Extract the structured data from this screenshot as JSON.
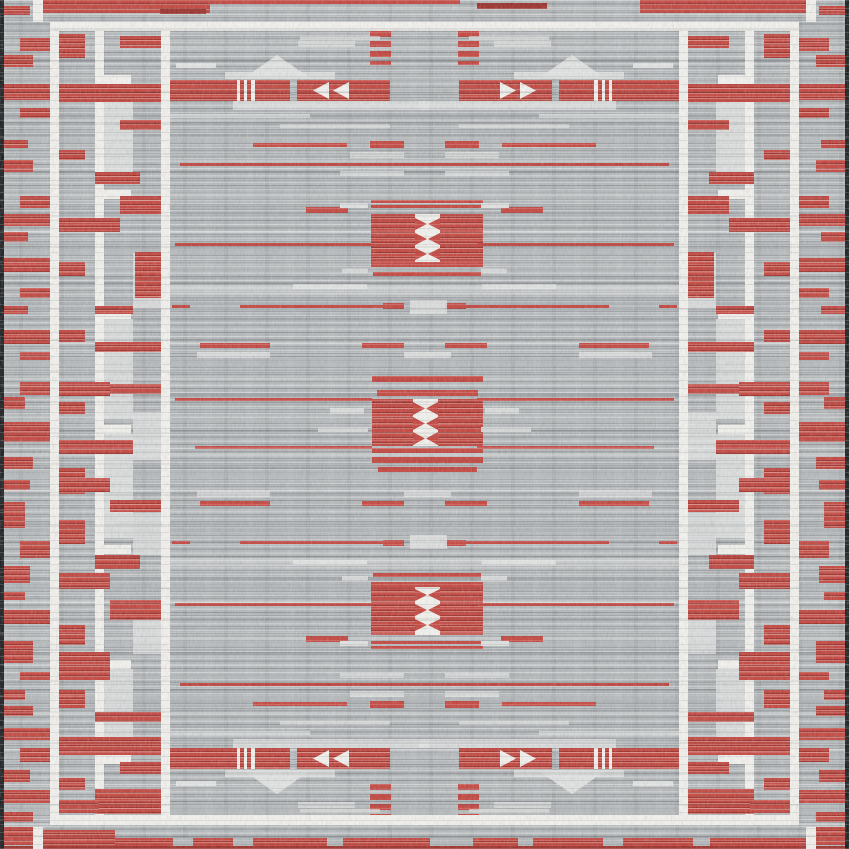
{
  "description": "Flat-woven area rug, top view: gray striated field with red geometric bands, white framing lines and ladder guards, three central red medallions with white hourglass motifs, pyramid motifs above and below the red banner rows, red-flecked outer border and dark selvage edges",
  "palette": {
    "base": "#b4b8ba",
    "black": "#17181a",
    "white": "#f4f3ef",
    "light": "#d6d9d8",
    "lighter": "#e2e4e3",
    "shadow": "#8f959a",
    "red": "#c5413a",
    "red_dark": "#9c2b25",
    "red_light": "#d4766d"
  },
  "pattern": {
    "canvas": {
      "w": 849,
      "h": 849
    },
    "element_format": "[x, y, w, h, colorKey, mirrorCode(1=mirrorX,2=mirrorY,3=both), triangleDir, opacity]",
    "elements": [
      [
        4,
        110,
        841,
        14,
        "g",
        0,
        "",
        0.2
      ],
      [
        4,
        298,
        841,
        10,
        "g",
        0,
        "",
        0.18
      ],
      [
        4,
        520,
        841,
        12,
        "g",
        0,
        "",
        0.15
      ],
      [
        4,
        700,
        841,
        9,
        "g",
        0,
        "",
        0.18
      ],
      [
        170,
        285,
        509,
        9,
        "ll",
        0,
        "",
        0.5
      ],
      [
        170,
        558,
        509,
        8,
        "ll",
        0,
        "",
        0.45
      ],
      [
        95,
        31,
        9,
        784,
        "w",
        1
      ],
      [
        95,
        75,
        36,
        9,
        "w",
        1
      ],
      [
        95,
        190,
        36,
        9,
        "w",
        1
      ],
      [
        95,
        310,
        36,
        9,
        "w",
        1
      ],
      [
        95,
        425,
        36,
        9,
        "w",
        1
      ],
      [
        95,
        545,
        36,
        9,
        "w",
        1
      ],
      [
        95,
        660,
        36,
        9,
        "w",
        1
      ],
      [
        95,
        755,
        36,
        9,
        "w",
        1
      ],
      [
        104,
        84,
        29,
        100,
        "ll",
        1,
        "",
        0.85
      ],
      [
        104,
        319,
        29,
        100,
        "ll",
        1,
        "",
        0.8
      ],
      [
        104,
        434,
        29,
        104,
        "ll",
        1,
        "",
        0.85
      ],
      [
        104,
        669,
        29,
        80,
        "ll",
        1,
        "",
        0.8
      ],
      [
        133,
        253,
        28,
        55,
        "ll",
        1,
        "",
        0.8
      ],
      [
        133,
        412,
        28,
        48,
        "ll",
        1,
        "",
        0.8
      ],
      [
        133,
        513,
        28,
        42,
        "ll",
        1,
        "",
        0.75
      ],
      [
        133,
        608,
        28,
        46,
        "ll",
        1,
        "",
        0.8
      ],
      [
        43,
        0,
        167,
        13,
        "r"
      ],
      [
        210,
        0,
        250,
        4,
        "rs"
      ],
      [
        477,
        3,
        70,
        6,
        "dr"
      ],
      [
        640,
        0,
        166,
        13,
        "r"
      ],
      [
        160,
        9,
        46,
        5,
        "dr"
      ],
      [
        4,
        827,
        29,
        18,
        "r"
      ],
      [
        43,
        830,
        72,
        16,
        "r"
      ],
      [
        115,
        838,
        691,
        11,
        "r"
      ],
      [
        173,
        838,
        20,
        11,
        "b"
      ],
      [
        233,
        838,
        20,
        11,
        "b"
      ],
      [
        327,
        838,
        16,
        11,
        "b"
      ],
      [
        430,
        838,
        43,
        11,
        "b"
      ],
      [
        518,
        838,
        15,
        11,
        "b"
      ],
      [
        603,
        838,
        20,
        11,
        "b"
      ],
      [
        693,
        838,
        17,
        11,
        "b"
      ],
      [
        816,
        827,
        29,
        18,
        "r"
      ],
      [
        4,
        846,
        841,
        3,
        "dr"
      ],
      [
        3,
        6,
        27,
        9,
        "r",
        1
      ],
      [
        20,
        38,
        30,
        13,
        "r",
        1
      ],
      [
        3,
        55,
        30,
        12,
        "r",
        1
      ],
      [
        3,
        84,
        47,
        16,
        "r",
        1
      ],
      [
        20,
        108,
        30,
        10,
        "r",
        1
      ],
      [
        3,
        140,
        25,
        8,
        "r",
        1
      ],
      [
        3,
        160,
        30,
        12,
        "r",
        1
      ],
      [
        20,
        196,
        30,
        12,
        "r",
        1
      ],
      [
        3,
        214,
        47,
        12,
        "r",
        1
      ],
      [
        3,
        232,
        25,
        10,
        "r",
        1
      ],
      [
        3,
        258,
        47,
        14,
        "r",
        1
      ],
      [
        20,
        288,
        30,
        10,
        "r",
        1
      ],
      [
        3,
        306,
        25,
        8,
        "r",
        1
      ],
      [
        3,
        330,
        47,
        14,
        "r",
        1
      ],
      [
        20,
        352,
        30,
        8,
        "r",
        1
      ],
      [
        20,
        382,
        30,
        13,
        "r",
        1
      ],
      [
        3,
        397,
        22,
        12,
        "r",
        1
      ],
      [
        3,
        422,
        47,
        20,
        "r",
        1
      ],
      [
        3,
        457,
        30,
        12,
        "r",
        1
      ],
      [
        3,
        480,
        27,
        10,
        "r",
        1
      ],
      [
        3,
        502,
        22,
        26,
        "r",
        1
      ],
      [
        20,
        541,
        30,
        17,
        "r",
        1
      ],
      [
        3,
        566,
        27,
        17,
        "r",
        1
      ],
      [
        3,
        592,
        22,
        8,
        "r",
        1
      ],
      [
        3,
        610,
        47,
        14,
        "r",
        1
      ],
      [
        3,
        641,
        30,
        22,
        "r",
        1
      ],
      [
        20,
        672,
        30,
        8,
        "r",
        1
      ],
      [
        3,
        690,
        22,
        10,
        "r",
        1
      ],
      [
        3,
        706,
        30,
        10,
        "r",
        1
      ],
      [
        3,
        728,
        47,
        12,
        "r",
        1
      ],
      [
        20,
        748,
        30,
        14,
        "r",
        1
      ],
      [
        3,
        770,
        27,
        12,
        "r",
        1
      ],
      [
        3,
        790,
        47,
        13,
        "r",
        1
      ],
      [
        3,
        812,
        30,
        10,
        "r",
        1
      ],
      [
        58,
        34,
        27,
        24,
        "r",
        1
      ],
      [
        120,
        36,
        41,
        12,
        "r",
        1
      ],
      [
        58,
        84,
        103,
        18,
        "r",
        1
      ],
      [
        120,
        120,
        41,
        10,
        "r",
        1
      ],
      [
        58,
        150,
        27,
        10,
        "r",
        1
      ],
      [
        95,
        172,
        45,
        12,
        "r",
        1
      ],
      [
        120,
        196,
        41,
        18,
        "r",
        1
      ],
      [
        58,
        218,
        62,
        14,
        "r",
        1
      ],
      [
        135,
        252,
        26,
        46,
        "r",
        1
      ],
      [
        58,
        262,
        27,
        14,
        "r",
        1
      ],
      [
        95,
        306,
        38,
        8,
        "r",
        1
      ],
      [
        58,
        330,
        27,
        12,
        "r",
        1
      ],
      [
        95,
        342,
        66,
        10,
        "r",
        1
      ],
      [
        58,
        382,
        52,
        14,
        "r",
        1
      ],
      [
        110,
        384,
        51,
        10,
        "r",
        1
      ],
      [
        58,
        402,
        27,
        12,
        "r",
        1
      ],
      [
        58,
        440,
        75,
        14,
        "r",
        1
      ],
      [
        58,
        468,
        27,
        26,
        "r",
        1
      ],
      [
        85,
        478,
        25,
        14,
        "r",
        1
      ],
      [
        110,
        500,
        51,
        12,
        "r",
        1
      ],
      [
        58,
        520,
        27,
        24,
        "r",
        1
      ],
      [
        95,
        555,
        45,
        14,
        "r",
        1
      ],
      [
        58,
        573,
        52,
        16,
        "r",
        1
      ],
      [
        110,
        600,
        51,
        20,
        "r",
        1
      ],
      [
        58,
        625,
        27,
        20,
        "r",
        1
      ],
      [
        58,
        652,
        52,
        28,
        "r",
        1
      ],
      [
        58,
        690,
        27,
        18,
        "r",
        1
      ],
      [
        95,
        712,
        66,
        10,
        "r",
        1
      ],
      [
        58,
        737,
        103,
        18,
        "r",
        1
      ],
      [
        120,
        762,
        41,
        12,
        "r",
        1
      ],
      [
        58,
        778,
        27,
        12,
        "r",
        1
      ],
      [
        95,
        789,
        66,
        25,
        "r",
        1
      ],
      [
        58,
        800,
        41,
        13,
        "r",
        1
      ],
      [
        370,
        31,
        21,
        34,
        "rv",
        3
      ],
      [
        298,
        41,
        57,
        6,
        "l",
        3
      ],
      [
        176,
        63,
        40,
        5,
        "ll",
        3
      ],
      [
        300,
        36,
        80,
        4,
        "ll",
        3,
        "",
        0.7
      ],
      [
        244,
        55,
        66,
        23,
        "ll",
        3,
        "up"
      ],
      [
        225,
        72,
        110,
        7,
        "ll",
        3,
        "",
        0.85
      ],
      [
        170,
        80,
        120,
        21,
        "r",
        3
      ],
      [
        237,
        80,
        3,
        21,
        "w",
        3
      ],
      [
        244,
        80,
        3,
        21,
        "w",
        3
      ],
      [
        251,
        80,
        4,
        21,
        "w",
        3
      ],
      [
        297,
        80,
        93,
        21,
        "r",
        3
      ],
      [
        313,
        82,
        16,
        17,
        "w",
        3,
        "left"
      ],
      [
        333,
        82,
        16,
        17,
        "w",
        3,
        "left"
      ],
      [
        233,
        101,
        197,
        9,
        "ll",
        3,
        "",
        0.8
      ],
      [
        170,
        114,
        140,
        4,
        "ll",
        3,
        "",
        0.75
      ],
      [
        280,
        124,
        110,
        4,
        "ll",
        3,
        "",
        0.7
      ],
      [
        253,
        143,
        94,
        4,
        "rs",
        3
      ],
      [
        370,
        141,
        34,
        7,
        "rs",
        3
      ],
      [
        350,
        152,
        54,
        6,
        "l",
        3
      ],
      [
        180,
        163,
        489,
        3,
        "rs",
        2
      ],
      [
        340,
        171,
        64,
        5,
        "ll",
        3,
        "",
        0.75
      ],
      [
        371,
        200,
        112,
        3,
        "rs",
        2
      ],
      [
        371,
        205,
        112,
        3,
        "rs",
        2
      ],
      [
        371,
        214,
        112,
        48,
        "r",
        2
      ],
      [
        415,
        214,
        25,
        48,
        "w",
        2
      ],
      [
        415,
        218,
        12,
        12,
        "rs",
        2,
        "right"
      ],
      [
        428,
        218,
        12,
        12,
        "rs",
        2,
        "left"
      ],
      [
        415,
        233,
        12,
        12,
        "rs",
        2,
        "right"
      ],
      [
        428,
        233,
        12,
        12,
        "rs",
        2,
        "left"
      ],
      [
        415,
        248,
        12,
        12,
        "rs",
        2,
        "right"
      ],
      [
        428,
        248,
        12,
        12,
        "rs",
        2,
        "left"
      ],
      [
        371,
        262,
        112,
        5,
        "rs",
        2
      ],
      [
        373,
        272,
        108,
        4,
        "rs",
        2
      ],
      [
        306,
        207,
        42,
        6,
        "rs",
        3
      ],
      [
        340,
        203,
        28,
        5,
        "ll",
        3
      ],
      [
        175,
        243,
        196,
        3,
        "rs",
        3
      ],
      [
        342,
        268,
        26,
        5,
        "l",
        3
      ],
      [
        293,
        284,
        74,
        5,
        "ll",
        3
      ],
      [
        172,
        305,
        18,
        3,
        "rs",
        3
      ],
      [
        240,
        305,
        164,
        3,
        "rs",
        3
      ],
      [
        383,
        303,
        21,
        6,
        "rs",
        3
      ],
      [
        410,
        300,
        37,
        14,
        "ll",
        2,
        "",
        0.85
      ],
      [
        200,
        343,
        70,
        5,
        "rs",
        3
      ],
      [
        362,
        343,
        42,
        5,
        "rs",
        3
      ],
      [
        197,
        352,
        73,
        6,
        "ll",
        3,
        "",
        0.8
      ],
      [
        404,
        352,
        47,
        6,
        "ll",
        2,
        "",
        0.85
      ],
      [
        372,
        376,
        111,
        6,
        "rs"
      ],
      [
        377,
        390,
        101,
        6,
        "rs"
      ],
      [
        372,
        399,
        111,
        47,
        "r"
      ],
      [
        413,
        399,
        25,
        47,
        "w"
      ],
      [
        413,
        402,
        12,
        13,
        "rs",
        0,
        "right"
      ],
      [
        426,
        402,
        12,
        13,
        "rs",
        0,
        "left"
      ],
      [
        413,
        417,
        12,
        13,
        "rs",
        0,
        "right"
      ],
      [
        426,
        417,
        12,
        13,
        "rs",
        0,
        "left"
      ],
      [
        413,
        432,
        12,
        13,
        "rs",
        0,
        "right"
      ],
      [
        426,
        432,
        12,
        13,
        "rs",
        0,
        "left"
      ],
      [
        372,
        448,
        111,
        5,
        "rs"
      ],
      [
        372,
        457,
        111,
        6,
        "rs"
      ],
      [
        378,
        467,
        99,
        5,
        "rs"
      ],
      [
        175,
        398,
        197,
        3,
        "rs",
        1
      ],
      [
        195,
        446,
        177,
        3,
        "rs",
        1
      ],
      [
        330,
        408,
        34,
        6,
        "ll",
        1,
        "",
        0.85
      ],
      [
        318,
        427,
        50,
        5,
        "l",
        1
      ],
      [
        50,
        22,
        749,
        9,
        "w"
      ],
      [
        50,
        815,
        749,
        10,
        "w"
      ],
      [
        50,
        22,
        9,
        802,
        "w",
        1
      ],
      [
        161,
        31,
        9,
        784,
        "w",
        1
      ],
      [
        33,
        0,
        10,
        22,
        "w",
        3
      ],
      [
        0,
        0,
        4,
        849,
        "k",
        1
      ]
    ]
  }
}
